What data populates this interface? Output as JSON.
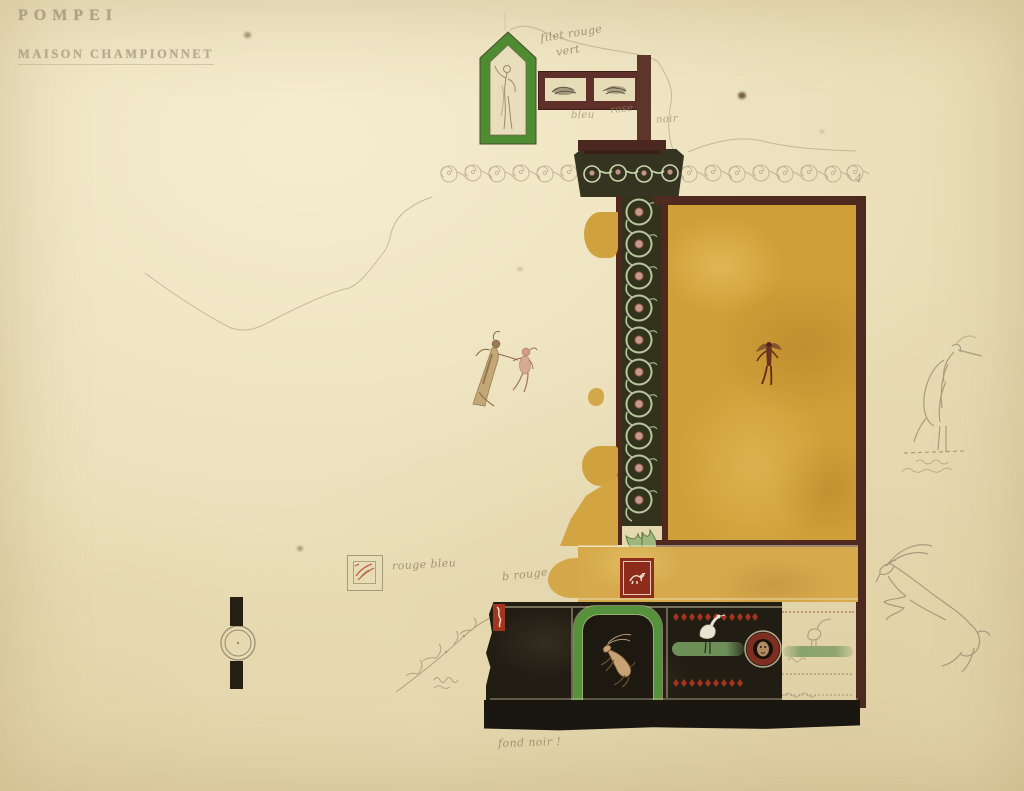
{
  "sheet": {
    "title": "POMPEI",
    "subtitle": "MAISON CHAMPIONNET"
  },
  "notes": {
    "filet_rouge": "filet rouge",
    "vert": "vert",
    "bleu": "bleu",
    "rose": "rose",
    "noir": "noir",
    "rouge_bleu": "rouge bleu",
    "b_rouge": "b rouge",
    "fond_noir": "fond noir !",
    "frieze_mark": "4"
  },
  "palette": {
    "paper": "#e9ddb6",
    "gold_panel": "#cfa038",
    "ochre_band": "#d6aa4c",
    "green_frame": "#55923b",
    "aedicula_green": "#4f8c31",
    "maroon_frame": "#4e2a20",
    "plum_frame": "#5e3029",
    "socle_black": "#221d13",
    "red_tablet": "#8e2c1b",
    "lace_red": "#a23420",
    "garland_green": "#6d9058",
    "pencil": "#a6997c"
  },
  "motifs": {
    "aedicula": "statuette in green aedicula",
    "candelabrum": "scroll candelabrum pilaster",
    "gold_panel": "gold panel with flying genius",
    "white_panel": "white panel with floating couple",
    "predella": "black predella: leaping goat, heron on garland, mask medallion",
    "margin_studies": "pencil studies of a heron and a leaping goat"
  }
}
